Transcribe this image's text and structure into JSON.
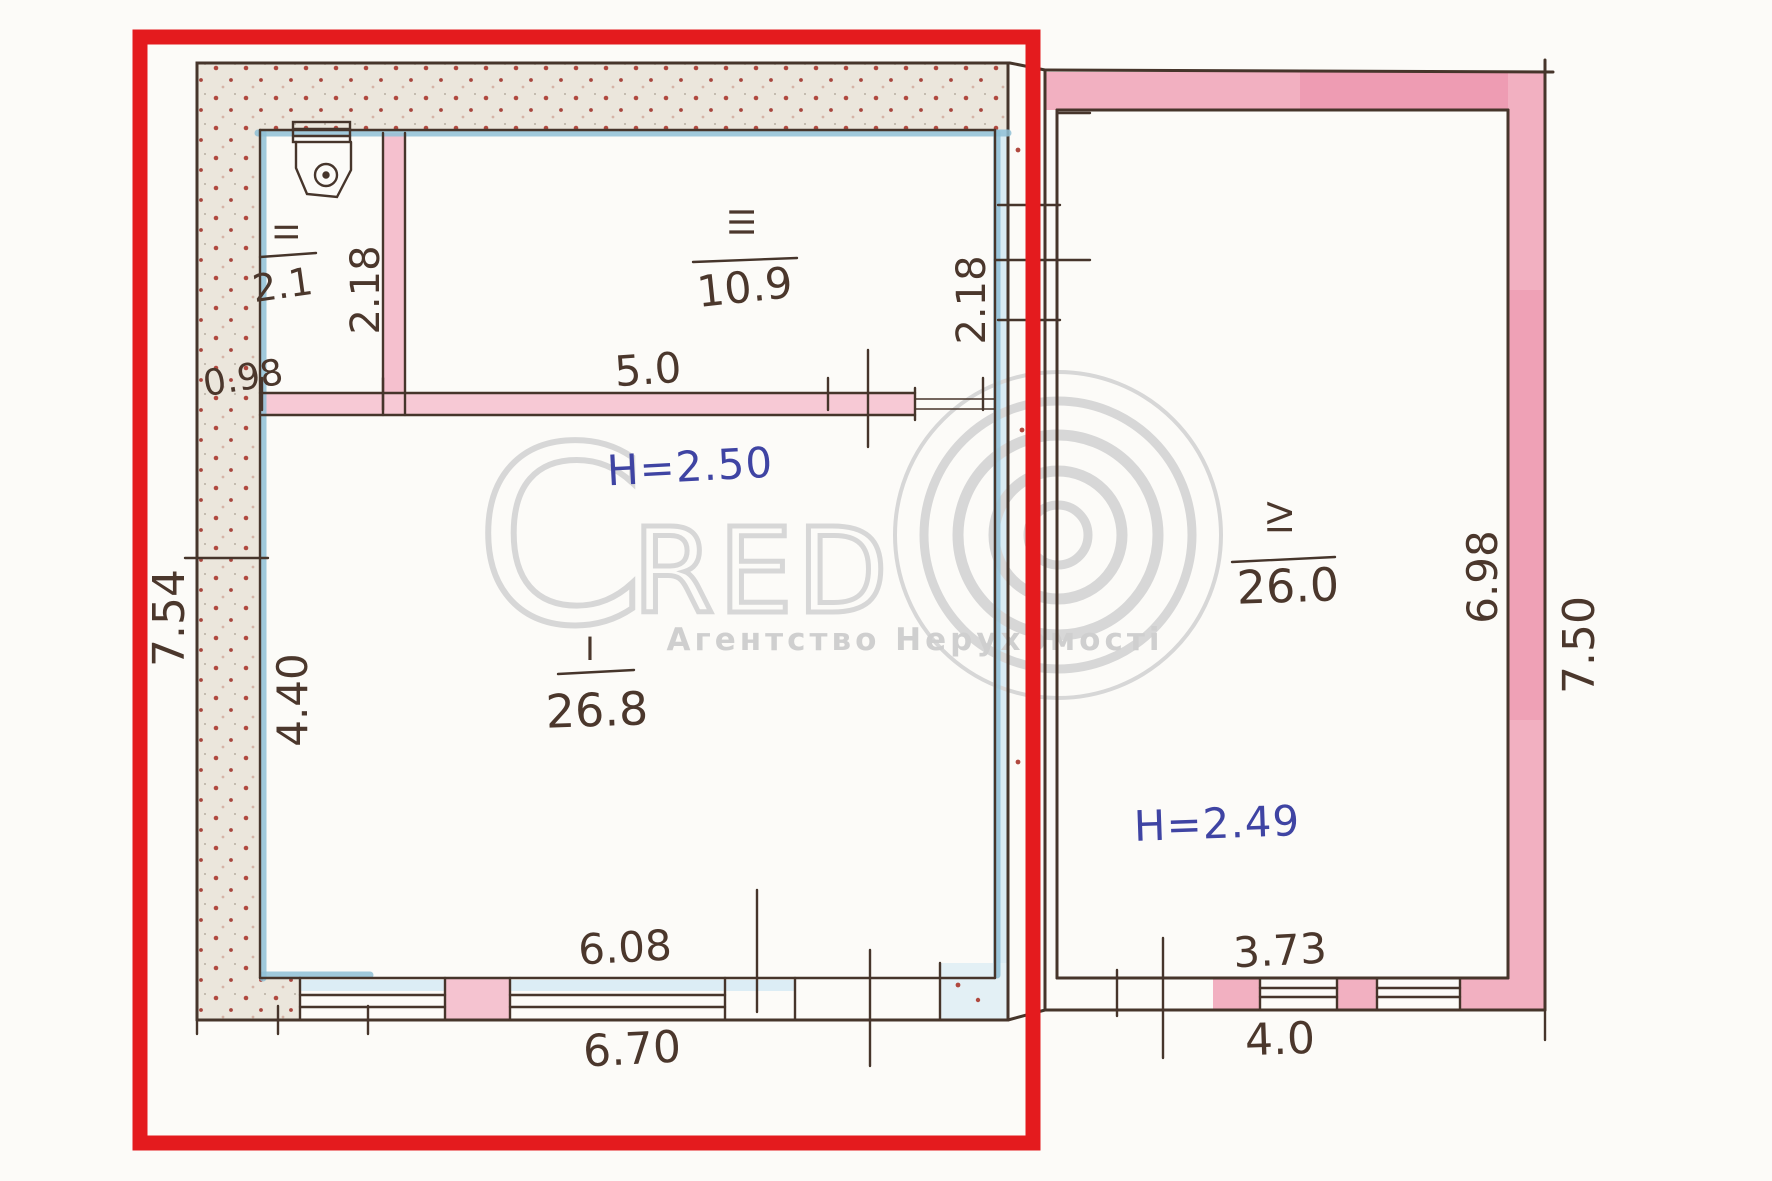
{
  "page": {
    "description": "Scanned hand-drawn floor plan of two adjoining buildings; left building outlined with a red highlight rectangle"
  },
  "colors": {
    "highlight_red": "#e41b1e",
    "ink_dark": "#46352b",
    "ink_blue": "#3f44a3",
    "wall_pink": "#f2b0c1",
    "wall_pink_deep": "#ec95ad",
    "wall_blue_edge": "#8fc0d6",
    "stipple_background": "#ebe6dc",
    "stipple_dot": "#b0493f",
    "watermark_gray": "#d7d7d7",
    "paper": "#fcfbf8"
  },
  "watermark": {
    "brand_c": "C",
    "brand_red": "RED",
    "brand_o_icon": "concentric-circles-icon",
    "subtitle": "Агентство Нерухомості"
  },
  "left_building": {
    "height_label": "H=2.50",
    "rooms": [
      {
        "number": "ІІ",
        "area": "2.1"
      },
      {
        "number": "ІІІ",
        "area": "10.9"
      },
      {
        "number": "І",
        "area": "26.8"
      }
    ],
    "dims": {
      "room2_width": "0.98",
      "room2_height": "2.18",
      "room3_width": "5.0",
      "room3_height": "2.18",
      "room1_height": "4.40",
      "outer_left_height": "7.54",
      "inner_bottom_width": "6.08",
      "outer_bottom_width": "6.70"
    }
  },
  "right_building": {
    "height_label": "H=2.49",
    "rooms": [
      {
        "number": "ІV",
        "area": "26.0"
      }
    ],
    "dims": {
      "inner_right_height": "6.98",
      "outer_right_height": "7.50",
      "bottom_inner_width": "3.73",
      "bottom_outer_width": "4.0"
    }
  }
}
